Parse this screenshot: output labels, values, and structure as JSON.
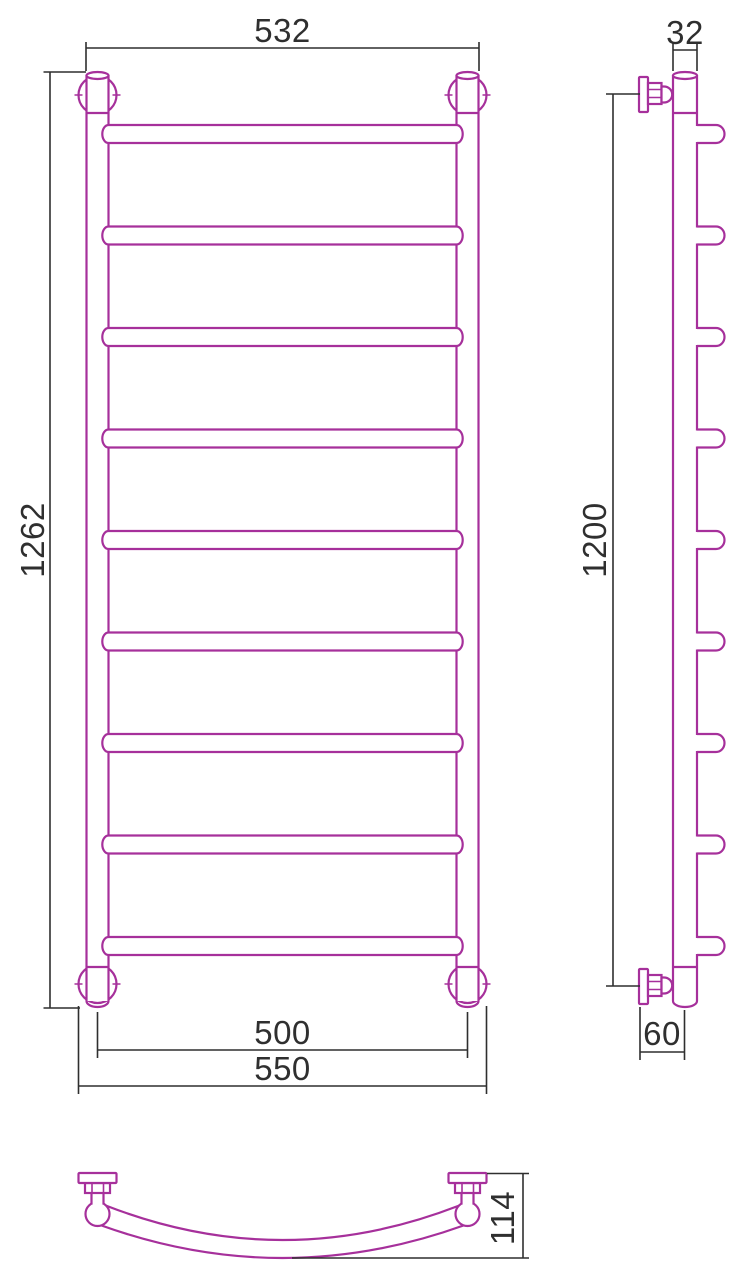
{
  "meta": {
    "figure": "ladder-towel-rail-technical-drawing",
    "views": [
      "front",
      "side",
      "bottom"
    ],
    "rung_count": 9,
    "colors": {
      "product": "#a6309b",
      "dimension": "#2f2f2f",
      "background": "#ffffff"
    }
  },
  "dimensions": {
    "front_top_width": "532",
    "front_height": "1262",
    "front_rail_spacing": "500",
    "front_overall_width": "550",
    "side_tube_width": "32",
    "side_mount_height": "1200",
    "side_wall_offset": "60",
    "bottom_depth": "114"
  }
}
